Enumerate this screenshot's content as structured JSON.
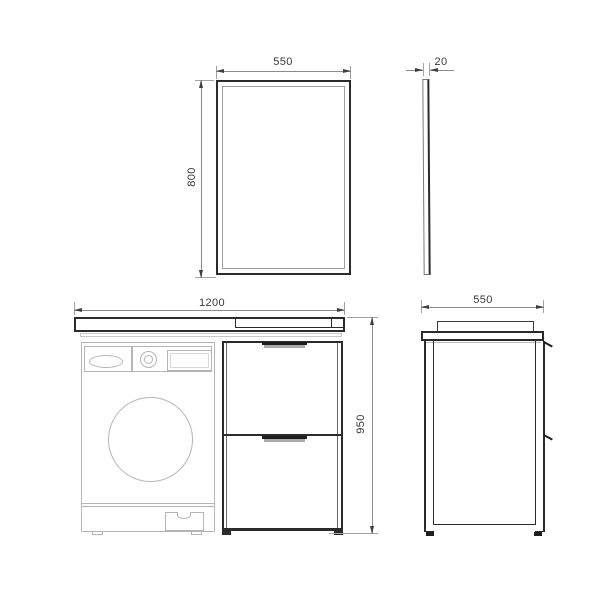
{
  "colors": {
    "background": "#ffffff",
    "outline_dark": "#2b2b2b",
    "outline_light": "#b5b5b5",
    "dimension_line": "#8c8c8c",
    "dimension_text": "#3a3a3a"
  },
  "dimensions": {
    "mirror_front": {
      "width": "550",
      "height": "800"
    },
    "mirror_side": {
      "thickness": "20"
    },
    "vanity_front": {
      "width": "1200",
      "height": "950"
    },
    "vanity_side": {
      "depth": "550"
    }
  }
}
